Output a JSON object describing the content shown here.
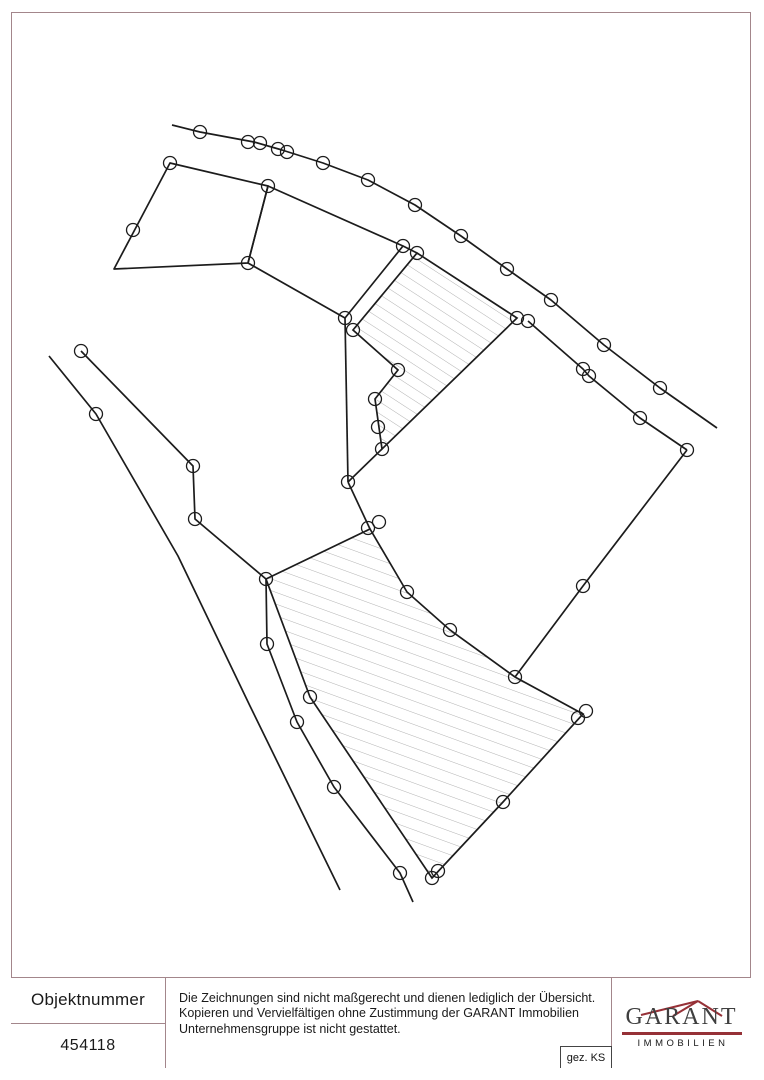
{
  "page": {
    "frame_color": "#a3868b",
    "background": "#ffffff"
  },
  "title_block": {
    "object_number_label": "Objektnummer",
    "object_number": "454118",
    "disclaimer": "Die Zeichnungen sind nicht maßgerecht und dienen lediglich der Übersicht.\nKopieren und Vervielfältigen ohne Zustimmung der GARANT Immobilien\nUnternehmensgruppe ist nicht gestattet.",
    "drawn_by": "gez. KS",
    "logo": {
      "name": "GARANT",
      "subtitle": "IMMOBILIEN",
      "accent_color": "#963137",
      "text_color": "#3f3f3f"
    }
  },
  "drawing": {
    "line_color": "#1c1c1c",
    "line_width": 1.7,
    "circle_radius": 6.5,
    "circle_stroke_width": 1.3,
    "hatch_color": "#b2b2b2",
    "polylines": [
      {
        "name": "road-top-boundary",
        "closed": false,
        "points": [
          [
            172,
            125
          ],
          [
            200,
            132
          ],
          [
            254,
            142
          ],
          [
            282,
            150
          ],
          [
            323,
            163
          ],
          [
            368,
            180
          ],
          [
            415,
            205
          ],
          [
            461,
            236
          ],
          [
            507,
            269
          ],
          [
            551,
            300
          ],
          [
            604,
            345
          ],
          [
            660,
            388
          ],
          [
            717,
            428
          ]
        ]
      },
      {
        "name": "west-road-outer-boundary",
        "closed": false,
        "points": [
          [
            49,
            356
          ],
          [
            96,
            414
          ],
          [
            178,
            556
          ],
          [
            250,
            706
          ],
          [
            340,
            890
          ]
        ]
      },
      {
        "name": "west-road-inner-boundary",
        "closed": false,
        "points": [
          [
            81,
            351
          ],
          [
            193,
            466
          ],
          [
            195,
            519
          ],
          [
            266,
            579
          ],
          [
            267,
            644
          ],
          [
            297,
            722
          ],
          [
            334,
            787
          ],
          [
            400,
            873
          ],
          [
            413,
            902
          ]
        ]
      },
      {
        "name": "north-parcel-1",
        "closed": true,
        "points": [
          [
            170,
            163
          ],
          [
            268,
            186
          ],
          [
            248,
            263
          ],
          [
            114,
            269
          ]
        ]
      },
      {
        "name": "north-parcel-2",
        "closed": true,
        "points": [
          [
            268,
            186
          ],
          [
            403,
            246
          ],
          [
            345,
            318
          ],
          [
            248,
            263
          ]
        ]
      },
      {
        "name": "ridge-segment",
        "closed": false,
        "points": [
          [
            403,
            246
          ],
          [
            417,
            253
          ]
        ]
      },
      {
        "name": "west-vertical-boundary",
        "closed": false,
        "points": [
          [
            345,
            318
          ],
          [
            348,
            482
          ]
        ]
      },
      {
        "name": "spur-to-strip-tip",
        "closed": false,
        "points": [
          [
            348,
            482
          ],
          [
            382,
            449
          ]
        ]
      },
      {
        "name": "spur-to-lower-parcel",
        "closed": false,
        "points": [
          [
            348,
            482
          ],
          [
            370,
            529
          ]
        ]
      },
      {
        "name": "middle-parcel-se-boundary",
        "closed": false,
        "points": [
          [
            515,
            677
          ],
          [
            583,
            586
          ],
          [
            687,
            450
          ]
        ]
      },
      {
        "name": "middle-parcel-road-boundary",
        "closed": false,
        "points": [
          [
            528,
            321
          ],
          [
            583,
            369
          ],
          [
            589,
            376
          ],
          [
            640,
            418
          ],
          [
            687,
            450
          ]
        ]
      }
    ],
    "hatched_parcels": [
      {
        "name": "upper-hatched-parcel",
        "pattern": "hatch-steep",
        "points": [
          [
            417,
            253
          ],
          [
            517,
            318
          ],
          [
            382,
            449
          ],
          [
            375,
            399
          ],
          [
            398,
            370
          ],
          [
            353,
            330
          ]
        ]
      },
      {
        "name": "lower-hatched-parcel",
        "pattern": "hatch-shallow",
        "points": [
          [
            266,
            579
          ],
          [
            370,
            529
          ],
          [
            407,
            592
          ],
          [
            450,
            630
          ],
          [
            515,
            677
          ],
          [
            583,
            714
          ],
          [
            503,
            802
          ],
          [
            432,
            878
          ],
          [
            310,
            697
          ]
        ]
      }
    ],
    "vertex_circles": [
      [
        200,
        132
      ],
      [
        248,
        142
      ],
      [
        260,
        143
      ],
      [
        278,
        149
      ],
      [
        287,
        152
      ],
      [
        323,
        163
      ],
      [
        368,
        180
      ],
      [
        415,
        205
      ],
      [
        461,
        236
      ],
      [
        507,
        269
      ],
      [
        551,
        300
      ],
      [
        604,
        345
      ],
      [
        660,
        388
      ],
      [
        170,
        163
      ],
      [
        268,
        186
      ],
      [
        248,
        263
      ],
      [
        133,
        230
      ],
      [
        403,
        246
      ],
      [
        417,
        253
      ],
      [
        345,
        318
      ],
      [
        353,
        330
      ],
      [
        517,
        318
      ],
      [
        528,
        321
      ],
      [
        398,
        370
      ],
      [
        375,
        399
      ],
      [
        378,
        427
      ],
      [
        382,
        449
      ],
      [
        348,
        482
      ],
      [
        368,
        528
      ],
      [
        379,
        522
      ],
      [
        583,
        369
      ],
      [
        589,
        376
      ],
      [
        640,
        418
      ],
      [
        687,
        450
      ],
      [
        583,
        586
      ],
      [
        515,
        677
      ],
      [
        266,
        579
      ],
      [
        407,
        592
      ],
      [
        450,
        630
      ],
      [
        578,
        718
      ],
      [
        586,
        711
      ],
      [
        503,
        802
      ],
      [
        432,
        878
      ],
      [
        438,
        871
      ],
      [
        310,
        697
      ],
      [
        81,
        351
      ],
      [
        96,
        414
      ],
      [
        193,
        466
      ],
      [
        195,
        519
      ],
      [
        267,
        644
      ],
      [
        297,
        722
      ],
      [
        334,
        787
      ],
      [
        400,
        873
      ]
    ]
  }
}
